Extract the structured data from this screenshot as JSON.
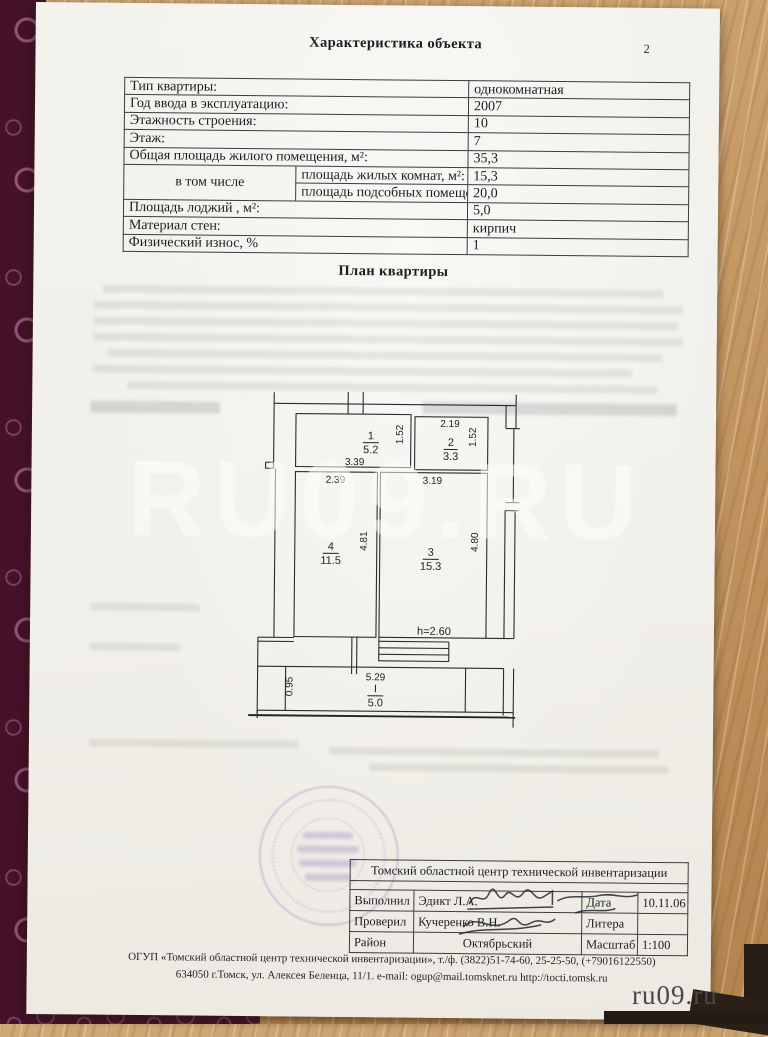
{
  "page": {
    "title": "Характеристика объекта",
    "page_number": "2",
    "plan_title": "План квартиры"
  },
  "characteristics": {
    "rows": [
      {
        "label": "Тип квартиры:",
        "value": "однокомнатная"
      },
      {
        "label": "Год ввода в эксплуатацию:",
        "value": "2007"
      },
      {
        "label": "Этажность строения:",
        "value": "10"
      },
      {
        "label": "Этаж:",
        "value": "7"
      },
      {
        "label": "Общая площадь жилого помещения, м²:",
        "value": "35,3"
      },
      {
        "group": "в том числе",
        "label": "площадь жилых комнат, м²:",
        "value": "15,3"
      },
      {
        "label": "площадь подсобных помещений, м²:",
        "value": "20,0"
      },
      {
        "label": "Площадь   лоджий , м²:",
        "value": "5,0"
      },
      {
        "label": "Материал стен:",
        "value": "кирпич"
      },
      {
        "label": "Физический износ, %",
        "value": "1"
      }
    ]
  },
  "plan": {
    "height_note": "h=2.60",
    "rooms": [
      {
        "num": "1",
        "area": "5.2",
        "width": "3.39",
        "depth": "1.52"
      },
      {
        "num": "2",
        "area": "3.3",
        "width": "2.19",
        "depth": "1.52"
      },
      {
        "num": "3",
        "area": "15.3",
        "width": "3.19",
        "depth": "4.80"
      },
      {
        "num": "4",
        "area": "11.5",
        "width": "2.39",
        "depth": "4.81"
      }
    ],
    "loggia": {
      "num": "I",
      "area": "5.0",
      "width": "5.29",
      "depth": "0.95"
    }
  },
  "org_table": {
    "org_name": "Томский областной центр технической инвентаризации",
    "rows": [
      {
        "col1": "Выполнил",
        "col2": "Эдикт Л.А.",
        "col3": "Дата",
        "col4": "10.11.06"
      },
      {
        "col1": "Проверил",
        "col2": "Кучеренко В.Н.",
        "col3": "Литера",
        "col4": ""
      },
      {
        "col1": "Район",
        "col2": "Октябрьский",
        "col3": "Масштаб",
        "col4": "1:100"
      }
    ]
  },
  "footer": {
    "line1": "ОГУП «Томский областной центр технической инвентаризации», т./ф. (3822)51-74-60, 25-25-50, (+79016122550)",
    "line2": "634050  г.Томск, ул. Алексея Беленца, 11/1. e-mail: ogup@mail.tomsknet.ru  http://tocti.tomsk.ru"
  },
  "watermarks": {
    "center": "RU09.RU",
    "corner": "ru09.ru"
  },
  "colors": {
    "paper": "#f3f1ec",
    "fabric": "#451229",
    "wood": "#c49a67",
    "ink": "#1c1c22",
    "stamp": "#7864b4",
    "watermark_corner": "#48484c"
  }
}
